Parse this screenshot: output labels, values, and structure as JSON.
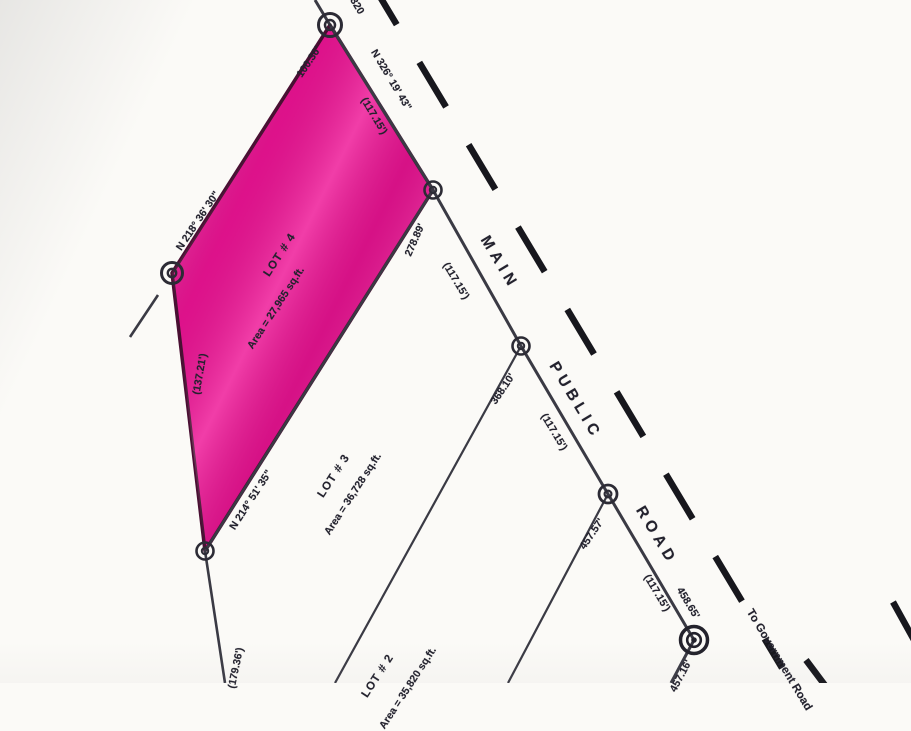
{
  "map": {
    "type": "cadastral-survey-plat",
    "road": {
      "words": [
        "MAIN",
        "PUBLIC",
        "ROAD"
      ],
      "destination": "To Government Road"
    },
    "lots": [
      {
        "name": "LOT # 4",
        "area": "Area = 27,965 sq.ft.",
        "highlighted": true
      },
      {
        "name": "LOT # 3",
        "area": "Area = 36,728 sq.ft.",
        "highlighted": false
      },
      {
        "name": "LOT # 2",
        "area": "Area = 35,820 sq.ft.",
        "highlighted": false
      }
    ]
  },
  "colors": {
    "lot4_fill": "#ee1395",
    "lot4_outline": "#4a0f33",
    "boundary_line": "#3a3a44",
    "road_dash": "#17171d",
    "text": "#23222e"
  },
  "labels": [
    {
      "name": "label-top-partial",
      "text": "320"
    },
    {
      "name": "label-bearing-frontage",
      "text": "N 326° 19' 43\""
    },
    {
      "name": "label-dist-frontage-1",
      "text": "(117.15')"
    },
    {
      "name": "label-dist-frontage-2",
      "text": "(117.15')"
    },
    {
      "name": "label-dist-frontage-3",
      "text": "(117.15')"
    },
    {
      "name": "label-dist-frontage-4",
      "text": "(117.15')"
    },
    {
      "name": "label-dist-458",
      "text": "458.65'"
    },
    {
      "name": "label-dist-partial-bottom",
      "text": "457.16'"
    },
    {
      "name": "label-road-word-main",
      "text": "MAIN"
    },
    {
      "name": "label-road-word-public",
      "text": "PUBLIC"
    },
    {
      "name": "label-road-word-road",
      "text": "ROAD"
    },
    {
      "name": "label-to-government-road",
      "text": "To Government Road"
    },
    {
      "name": "label-dist-100",
      "text": "100.36'"
    },
    {
      "name": "label-bearing-left-edge",
      "text": "N 218° 36' 30\""
    },
    {
      "name": "label-dist-137",
      "text": "(137.21')"
    },
    {
      "name": "label-dist-179",
      "text": "(179.36')"
    },
    {
      "name": "label-bearing-lot-line",
      "text": "N 214° 51' 35\""
    },
    {
      "name": "label-dist-278",
      "text": "278.89'"
    },
    {
      "name": "label-dist-368",
      "text": "368.10'"
    },
    {
      "name": "label-dist-457",
      "text": "457.57'"
    },
    {
      "name": "label-lot4-name",
      "text": "LOT # 4"
    },
    {
      "name": "label-lot4-area",
      "text": "Area = 27,965 sq.ft."
    },
    {
      "name": "label-lot3-name",
      "text": "LOT # 3"
    },
    {
      "name": "label-lot3-area",
      "text": "Area = 36,728 sq.ft."
    },
    {
      "name": "label-lot2-name",
      "text": "LOT # 2"
    },
    {
      "name": "label-lot2-area",
      "text": "Area = 35,820 sq.ft."
    }
  ]
}
